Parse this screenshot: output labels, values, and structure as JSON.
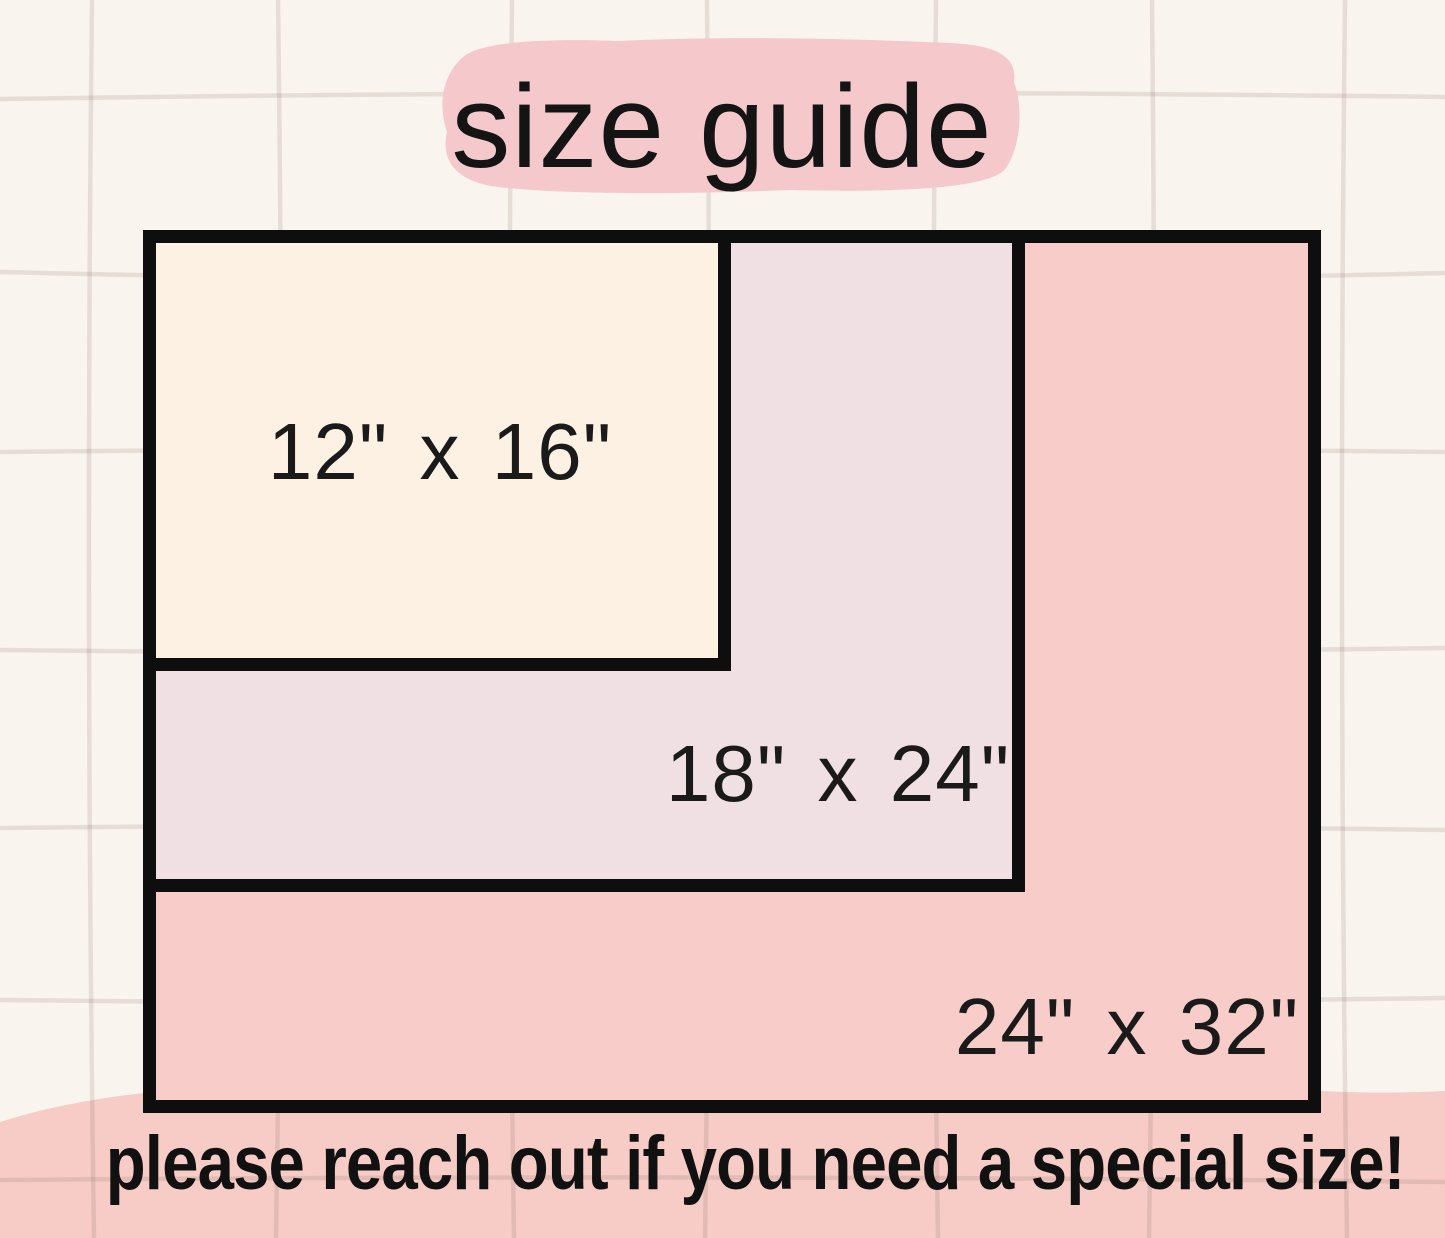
{
  "title": {
    "text": "size guide"
  },
  "sizes": [
    {
      "label": "12\" x 16\"",
      "width_in": 12,
      "height_in": 16
    },
    {
      "label": "18\" x 24\"",
      "width_in": 18,
      "height_in": 24
    },
    {
      "label": "24\" x 32\"",
      "width_in": 24,
      "height_in": 32
    }
  ],
  "footer": {
    "text": "please reach out if you need a special size!"
  },
  "colors": {
    "background": "#faf4ee",
    "grid_line": "#e8e2dc",
    "brush_pink": "#f5c9cc",
    "blob_pink": "#f7cbc6",
    "rect_12x16_fill": "#fdf1e3",
    "rect_18x24_fill": "#f0dfe3",
    "rect_24x32_fill": "#f8ccc8",
    "border_black": "#0e0e0e",
    "text_black": "#141414"
  }
}
